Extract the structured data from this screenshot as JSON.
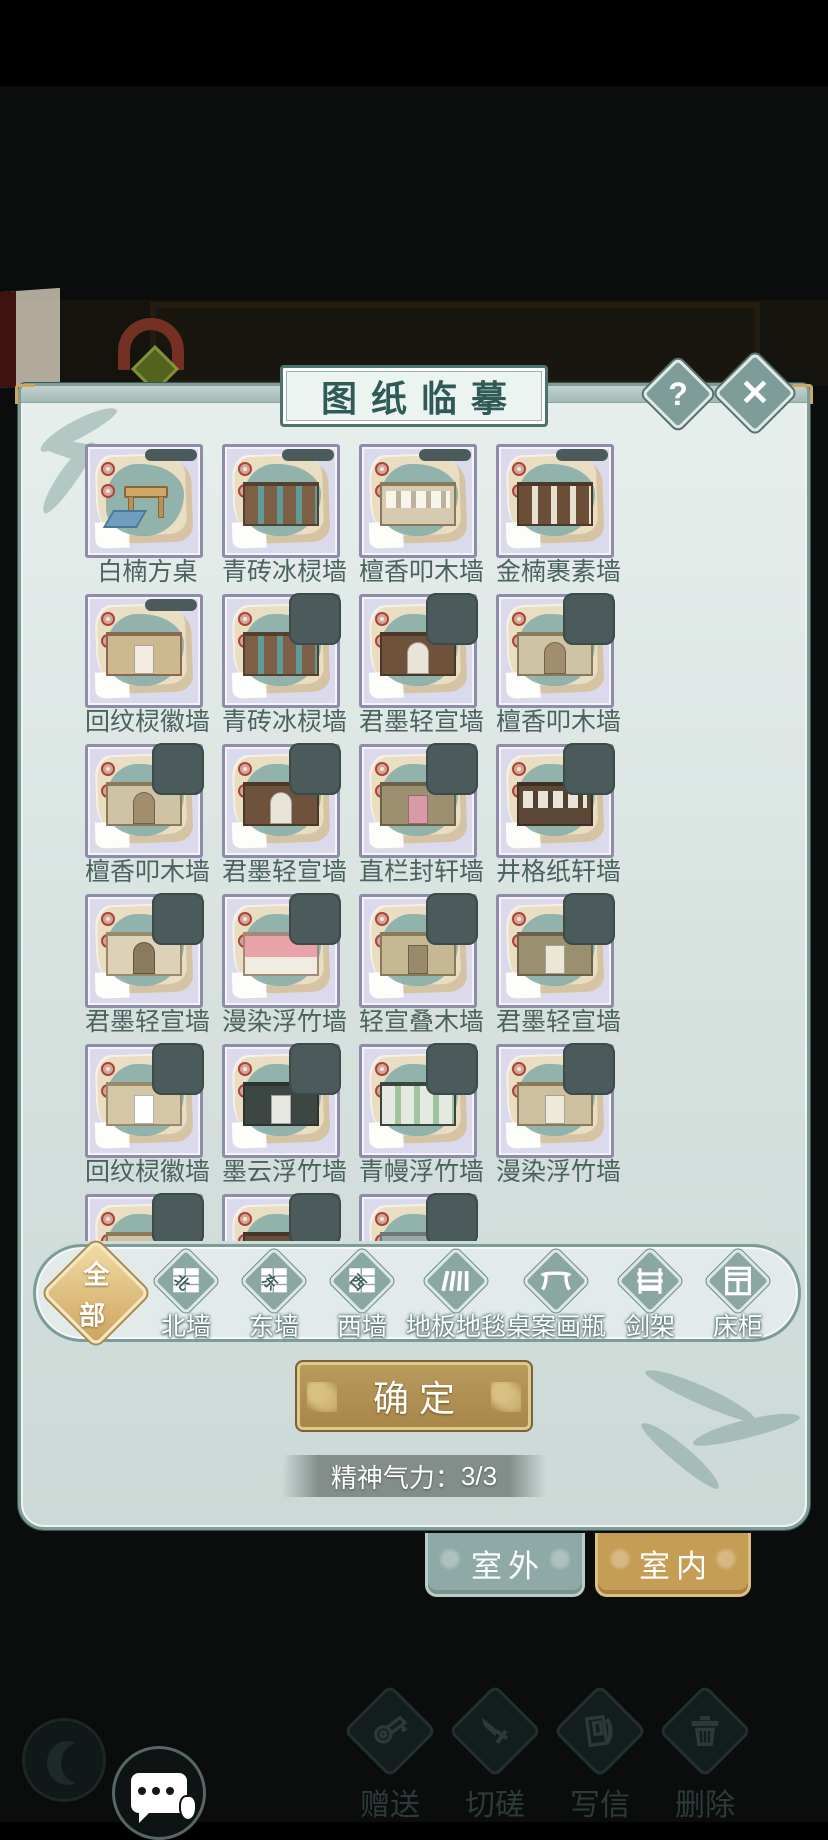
{
  "header": {
    "title": "图纸临摹",
    "help_label": "?",
    "close_glyph": "✕"
  },
  "accents": {
    "panel_teal": "#7f9c98",
    "card_purple": "#8e8bab",
    "gold": "#b08c4c",
    "seal_red": "#a9443a"
  },
  "grid": {
    "items": [
      {
        "label": "白楠方桌",
        "badge": "bar",
        "type": "table",
        "pattern": "none",
        "wall": "#cfa868",
        "accent": "#6f9fc0",
        "trim": "#8a6636"
      },
      {
        "label": "青砖冰棂墙",
        "badge": "bar",
        "type": "wall",
        "pattern": "panels",
        "wall": "#7d5f46",
        "accent": "#5f9b99",
        "trim": "#54402e"
      },
      {
        "label": "檀香叩木墙",
        "badge": "bar",
        "type": "wall",
        "pattern": "windows",
        "wall": "#d6cbb0",
        "accent": "#f7f4ea",
        "trim": "#8a7a5c"
      },
      {
        "label": "金楠裹素墙",
        "badge": "bar",
        "type": "wall",
        "pattern": "panels",
        "wall": "#6b4f38",
        "accent": "#e8e0d0",
        "trim": "#4c3826"
      },
      {
        "label": "回纹棂徽墙",
        "badge": "bar",
        "type": "wall",
        "pattern": "door",
        "wall": "#ccb98f",
        "accent": "#f2ece0",
        "trim": "#8a6a4e"
      },
      {
        "label": "青砖冰棂墙",
        "badge": "square",
        "type": "wall",
        "pattern": "panels",
        "wall": "#7d5f46",
        "accent": "#5f9b99",
        "trim": "#54402e"
      },
      {
        "label": "君墨轻宣墙",
        "badge": "square",
        "type": "wall",
        "pattern": "arch",
        "wall": "#6e523c",
        "accent": "#e8e4d8",
        "trim": "#4c3826"
      },
      {
        "label": "檀香叩木墙",
        "badge": "square",
        "type": "wall",
        "pattern": "arch",
        "wall": "#cfc3a6",
        "accent": "#a08e6e",
        "trim": "#8a7a5c"
      },
      {
        "label": "檀香叩木墙",
        "badge": "square",
        "type": "wall",
        "pattern": "arch",
        "wall": "#cfc3a6",
        "accent": "#a08e6e",
        "trim": "#8a7a5c"
      },
      {
        "label": "君墨轻宣墙",
        "badge": "square",
        "type": "wall",
        "pattern": "arch",
        "wall": "#6e523c",
        "accent": "#e8e4d8",
        "trim": "#4c3826"
      },
      {
        "label": "直栏封轩墙",
        "badge": "square",
        "type": "wall",
        "pattern": "door",
        "wall": "#9c9070",
        "accent": "#d89aa4",
        "trim": "#6b6148"
      },
      {
        "label": "井格纸轩墙",
        "badge": "square",
        "type": "wall",
        "pattern": "windows",
        "wall": "#5c4836",
        "accent": "#e8e4d8",
        "trim": "#3e3024"
      },
      {
        "label": "君墨轻宣墙",
        "badge": "square",
        "type": "wall",
        "pattern": "arch",
        "wall": "#ddd2b8",
        "accent": "#8a7a5e",
        "trim": "#9a8a6a"
      },
      {
        "label": "漫染浮竹墙",
        "badge": "square",
        "type": "wall",
        "pattern": "split",
        "wall": "#f0ece2",
        "accent": "#e8a2a8",
        "trim": "#a08a7a"
      },
      {
        "label": "轻宣叠木墙",
        "badge": "square",
        "type": "wall",
        "pattern": "door",
        "wall": "#c7b894",
        "accent": "#9a8a6a",
        "trim": "#8a7a58"
      },
      {
        "label": "君墨轻宣墙",
        "badge": "square",
        "type": "wall",
        "pattern": "door",
        "wall": "#9a8f6e",
        "accent": "#ece6d6",
        "trim": "#6b6148"
      },
      {
        "label": "回纹棂徽墙",
        "badge": "square",
        "type": "wall",
        "pattern": "door",
        "wall": "#d3c7a8",
        "accent": "#ffffff",
        "trim": "#9a8a6a"
      },
      {
        "label": "墨云浮竹墙",
        "badge": "square",
        "type": "wall",
        "pattern": "door",
        "wall": "#3c4642",
        "accent": "#e8e8e2",
        "trim": "#2c3430"
      },
      {
        "label": "青幔浮竹墙",
        "badge": "square",
        "type": "wall",
        "pattern": "panels",
        "wall": "#e4eae0",
        "accent": "#9ec4a0",
        "trim": "#3a4440"
      },
      {
        "label": "漫染浮竹墙",
        "badge": "square",
        "type": "wall",
        "pattern": "door",
        "wall": "#ccc0a0",
        "accent": "#efe9da",
        "trim": "#8a7a58"
      },
      {
        "label": "檀香叩木墙",
        "badge": "square",
        "type": "wall",
        "pattern": "windows",
        "wall": "#cfc3a4",
        "accent": "#f2eee2",
        "trim": "#8a7a5c"
      },
      {
        "label": "君墨轻宣墙",
        "badge": "square",
        "type": "wall",
        "pattern": "door",
        "wall": "#64503c",
        "accent": "#5f8f8c",
        "trim": "#44342a"
      },
      {
        "label": "青砖冰棂墙",
        "badge": "square",
        "type": "wall",
        "pattern": "door",
        "wall": "#9aa8a4",
        "accent": "#6f93b2",
        "trim": "#6b7a76"
      }
    ]
  },
  "filters": {
    "all_char_1": "全",
    "all_char_2": "部",
    "items": [
      {
        "label": "北墙",
        "icon": "brick-wall-north-icon",
        "glyph": "北"
      },
      {
        "label": "东墙",
        "icon": "brick-wall-east-icon",
        "glyph": "东"
      },
      {
        "label": "西墙",
        "icon": "brick-wall-west-icon",
        "glyph": "西"
      },
      {
        "label": "地板地毯",
        "icon": "floor-carpet-icon",
        "glyph": ""
      },
      {
        "label": "桌案画瓶",
        "icon": "table-vase-icon",
        "glyph": ""
      },
      {
        "label": "剑架",
        "icon": "sword-rack-icon",
        "glyph": ""
      },
      {
        "label": "床柜",
        "icon": "bed-cabinet-icon",
        "glyph": ""
      }
    ]
  },
  "confirm": {
    "label": "确定"
  },
  "energy": {
    "label": "精神气力：",
    "value": "3/3"
  },
  "tabs": {
    "outdoor_label": "室外",
    "indoor_label": "室内",
    "active": "室内"
  },
  "bottom_bar": {
    "items": [
      {
        "label": "赠送",
        "icon": "gift-scroll-icon"
      },
      {
        "label": "切磋",
        "icon": "spar-sword-icon"
      },
      {
        "label": "写信",
        "icon": "write-letter-icon"
      },
      {
        "label": "删除",
        "icon": "delete-trash-icon"
      }
    ]
  }
}
